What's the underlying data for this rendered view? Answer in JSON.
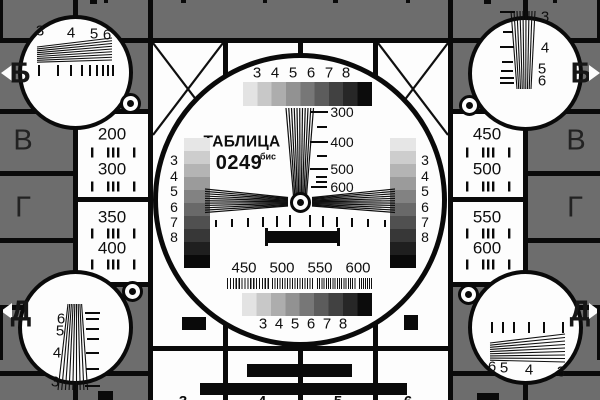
{
  "card": {
    "title": "ТАБЛИЦА",
    "number": "0249",
    "number_suffix": "бис"
  },
  "colors": {
    "background": "#6d6d6d",
    "panel_white": "#fdfdfd",
    "line_black": "#0a0a0a"
  },
  "edge_letters": {
    "left_b": "Б",
    "left_v": "В",
    "left_g": "Г",
    "left_d": "Д",
    "right_b": "Б",
    "right_v": "В",
    "right_g": "Г",
    "right_d": "Д"
  },
  "corner_digits": {
    "top_left": [
      "3",
      "4",
      "5",
      "6"
    ],
    "top_right": [
      "3",
      "4",
      "5",
      "6"
    ],
    "bottom_left": [
      "6",
      "5",
      "4",
      "3"
    ],
    "bottom_right": [
      "6",
      "5",
      "4",
      "3"
    ]
  },
  "left_panel_values": [
    "200",
    "300",
    "350",
    "400"
  ],
  "right_panel_values": [
    "450",
    "500",
    "550",
    "600"
  ],
  "grayscale_digits": [
    "3",
    "4",
    "5",
    "6",
    "7",
    "8"
  ],
  "wedge_labels": [
    "300",
    "400",
    "500",
    "600"
  ],
  "burst_labels": [
    "450",
    "500",
    "550",
    "600"
  ],
  "bottom_cut_digits": [
    "3",
    "4",
    "5",
    "6"
  ]
}
